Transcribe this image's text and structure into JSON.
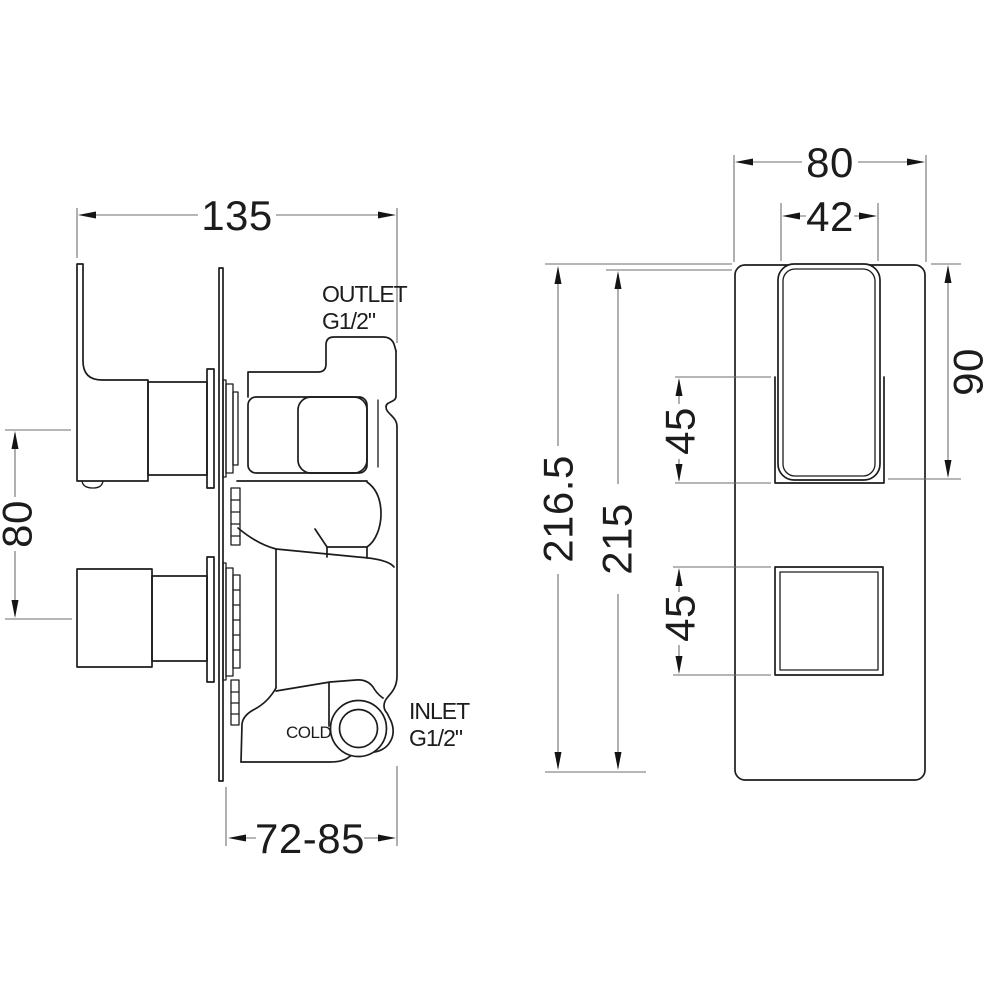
{
  "drawing": {
    "type": "technical-dimension-drawing",
    "subject": "concealed thermostatic shower valve, side and front elevation",
    "colors": {
      "background": "#ffffff",
      "outline": "#1c1c1c",
      "dimension_lines": "#6e6e6e",
      "text": "#1c1c1c"
    }
  },
  "labels": {
    "outlet_line1": "OUTLET",
    "outlet_line2": "G1/2\"",
    "inlet_line1": "INLET",
    "inlet_line2": "G1/2\"",
    "cold": "COLD"
  },
  "dimensions": {
    "side_total_depth": "135",
    "side_handle_spacing": "80",
    "side_wall_depth_range": "72-85",
    "front_plate_width": "80",
    "front_handle_width": "42",
    "front_overall_height": "216.5",
    "front_plate_height": "215",
    "front_handle_height": "90",
    "front_handle_recess_height": "45",
    "front_knob_recess_height": "45"
  }
}
